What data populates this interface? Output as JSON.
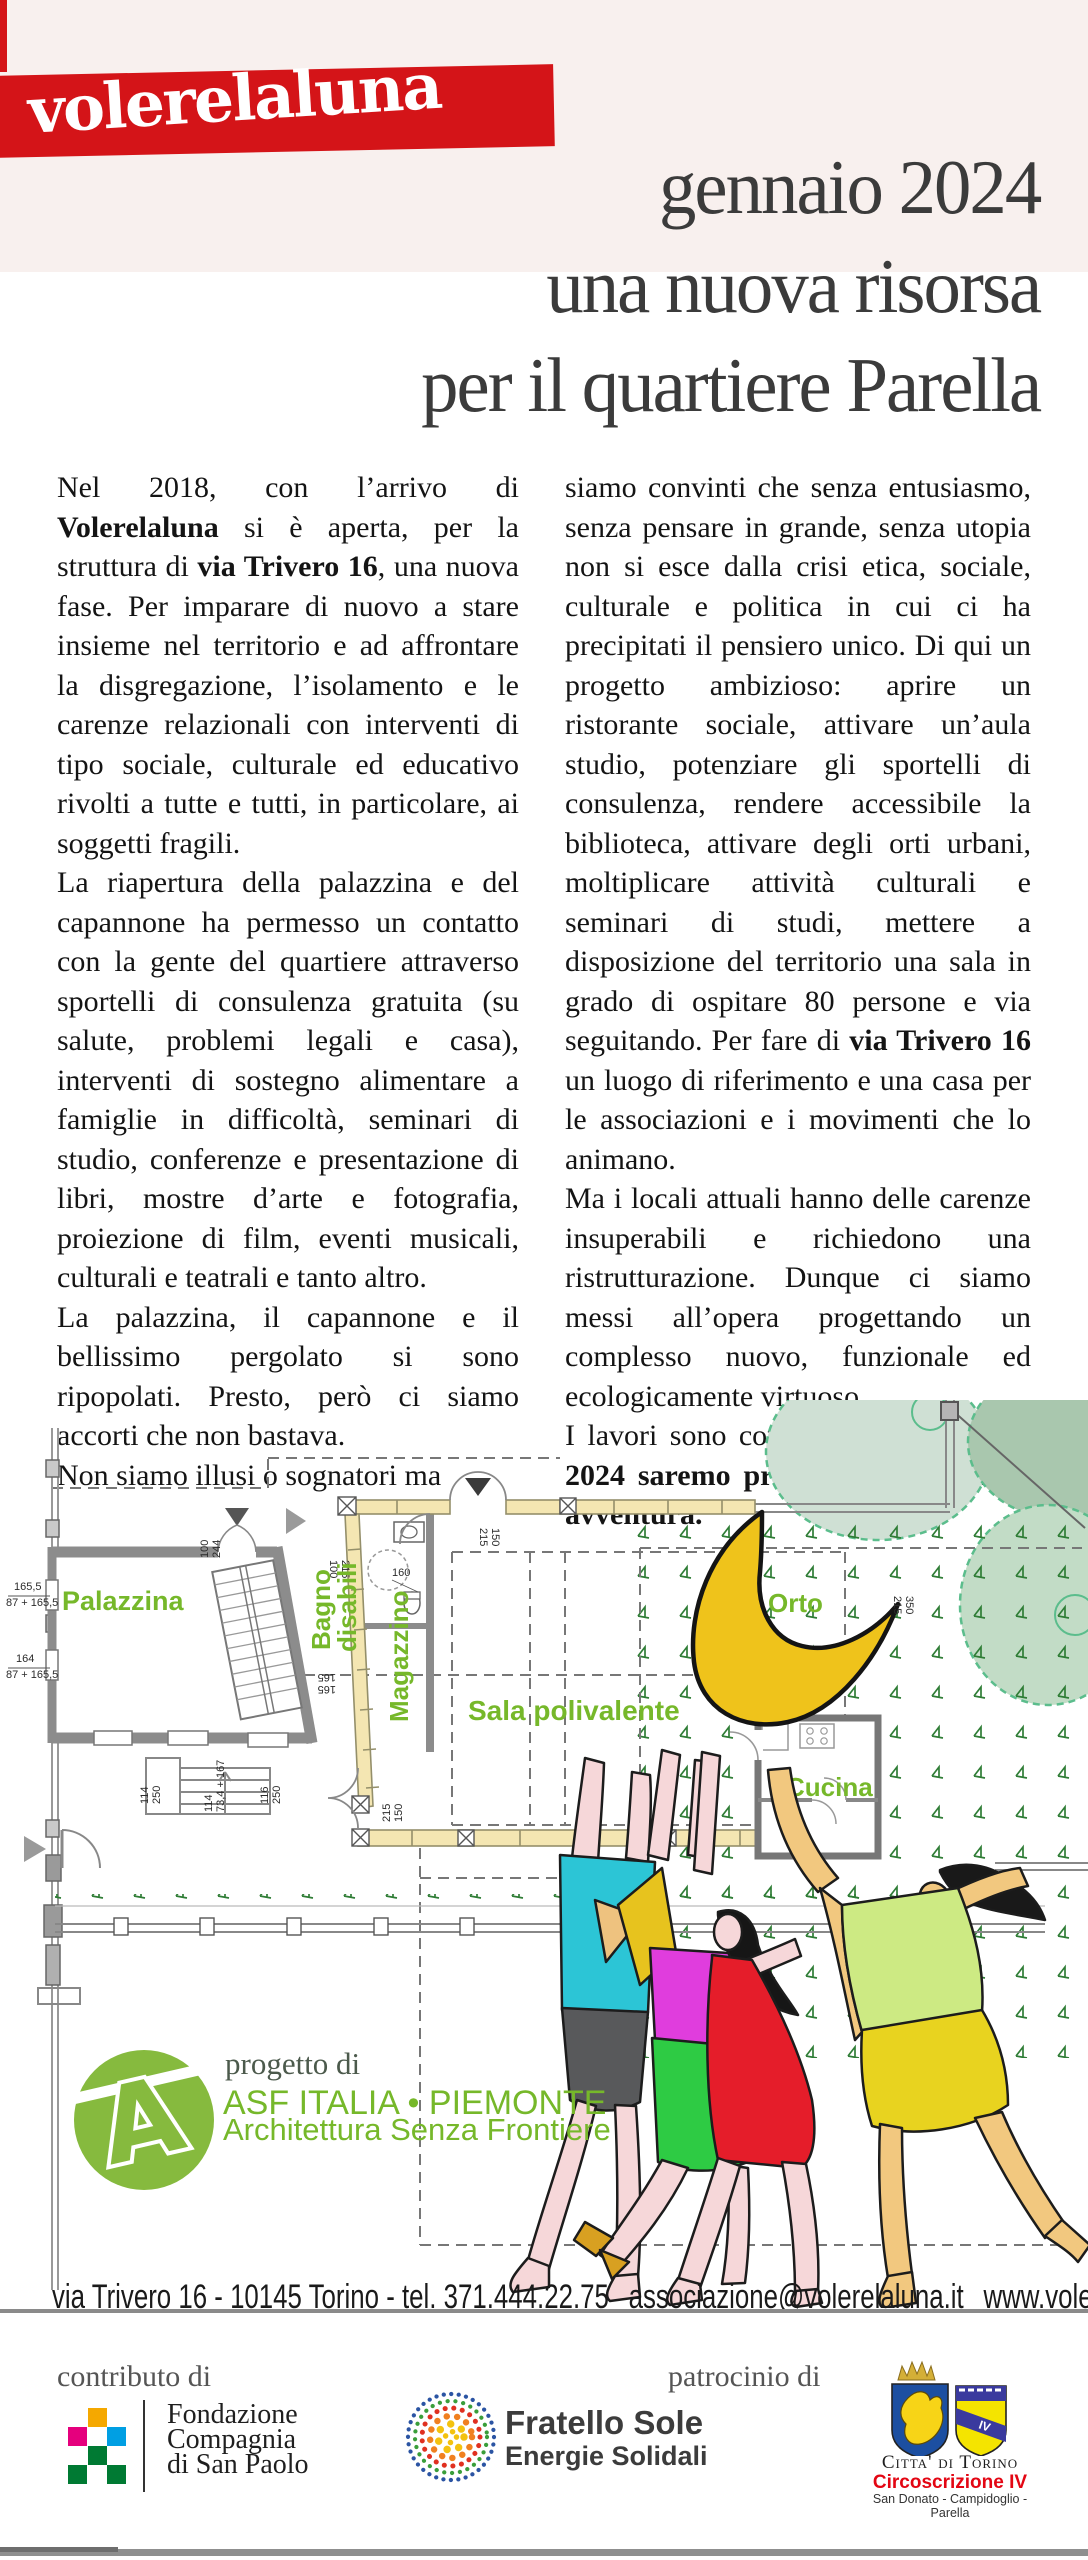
{
  "header": {
    "logo": "volerelaluna",
    "title_line1": "gennaio 2024",
    "title_line2": "una nuova risorsa",
    "title_line3": "per il quartiere Parella"
  },
  "article": {
    "left": [
      [
        {
          "t": "Nel 2018, con l’arrivo di "
        },
        {
          "t": "Volerelaluna",
          "b": true
        },
        {
          "t": " si è aperta, per la struttura di "
        },
        {
          "t": "via Trivero 16",
          "b": true
        },
        {
          "t": ", una nuova fase. Per imparare di nuovo a stare insieme nel territorio e ad affrontare la disgregazione, l’isolamento e le carenze relazionali con interventi di tipo sociale, culturale ed educativo rivolti a tutte e tutti, in particolare, ai soggetti fragili."
        }
      ],
      [
        {
          "t": "La riapertura della palazzina e del capannone ha permesso un contatto con la gente del quartiere attraverso sportelli di consulenza gratuita (su salute, problemi legali e casa), interventi di sostegno alimentare a famiglie in difficoltà, seminari di studio, conferenze e presentazione di libri, mostre d’arte e fotografia, proiezione di film, eventi musicali, culturali e teatrali e tanto altro."
        }
      ],
      [
        {
          "t": "La palazzina, il capannone e il bellissimo pergolato si sono ripopolati. Presto, però ci siamo accorti che non bastava."
        }
      ],
      [
        {
          "t": "Non siamo illusi o sognatori ma"
        }
      ]
    ],
    "right": [
      [
        {
          "t": "siamo convinti che senza entusiasmo, senza pensare in grande, senza utopia non si esce dalla crisi etica, sociale, culturale e politica in cui ci ha precipitati il pensiero unico. Di qui un progetto ambizioso: aprire un ristorante sociale, attivare un’aula studio, potenziare gli sportelli di consulenza, rendere accessibile la biblioteca, attivare degli orti urbani, moltiplicare attività culturali e seminari di studi, mettere a disposizione del territorio una sala in grado di ospitare 80 persone e via seguitando. Per fare di "
        },
        {
          "t": "via Trivero 16",
          "b": true
        },
        {
          "t": " un luogo di riferimento e una casa per le associazioni e i movimenti che lo animano."
        }
      ],
      [
        {
          "t": "Ma i locali attuali hanno delle carenze insuperabili e richiedono una ristrutturazione. Dunque ci siamo messi all’opera progettando un complesso nuovo, funzionale ed ecologicamente virtuoso."
        }
      ],
      [
        {
          "t": "I lavori sono cominciati e "
        },
        {
          "t": "a gennaio 2024 saremo pronti per una nuova avventura.",
          "b": true
        }
      ]
    ]
  },
  "plan": {
    "labels": {
      "palazzina": "Palazzina",
      "bagno1": "Bagno",
      "bagno2": "disabili",
      "magazzino": "Magazzino",
      "sala": "Sala polivalente",
      "orto": "Orto",
      "cucina": "Cucina"
    },
    "dims": {
      "w1a": "165,5",
      "w1b": "87 + 165,5",
      "w2a": "164",
      "w2b": "87 + 165,5",
      "door_a": "100",
      "door_b": "244",
      "bagno_a": "215",
      "bagno_b": "100",
      "wc": "160",
      "gate_a": "150",
      "gate_b": "215",
      "s1a": "114",
      "s1b": "250",
      "s2a": "114",
      "s2b": "73,4 + 167",
      "s3a": "116",
      "s3b": "250",
      "s4a": "165",
      "s4b": "165",
      "s5a": "215",
      "s5b": "150",
      "s6a": "350",
      "s6b": "215"
    }
  },
  "credits": {
    "progetto": "progetto di",
    "asf_line1": "ASF ITALIA • PIEMONTE",
    "asf_line2": "Architettura Senza Frontiere"
  },
  "footer": {
    "address": "via Trivero 16 - 10145 Torino - tel. 371.444.22.75",
    "email": "associazione@volerelaluna.it",
    "web1": "www.volerelaluna.it",
    "web2": "www.viatrivero.volerelaluna.it"
  },
  "sponsors": {
    "contributo": "contributo di",
    "patrocinio": "patrocinio di",
    "fondazione_lines": [
      "Fondazione",
      "Compagnia",
      "di San Paolo"
    ],
    "fratello_line1": "Fratello Sole",
    "fratello_line2": "Energie Solidali",
    "citta": "Citta' di Torino",
    "circoscrizione": "Circoscrizione IV",
    "zone": "San Donato - Campidoglio - Parella",
    "iv": "IV"
  },
  "colors": {
    "accent_red": "#d41418",
    "accent_green": "#76b82a",
    "moon_yellow": "#efc31b",
    "pink_band": "#f8f0ee"
  }
}
